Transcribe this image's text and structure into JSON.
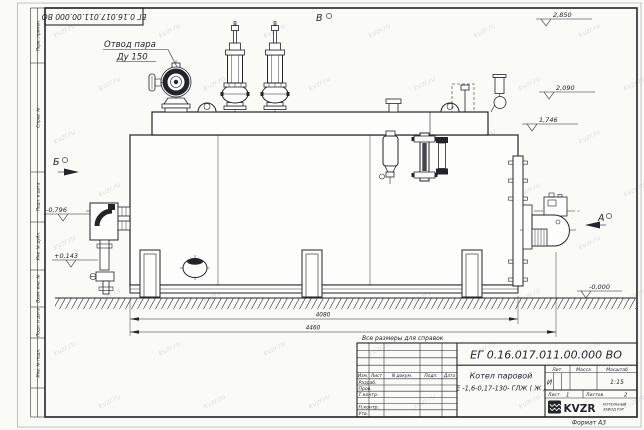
{
  "sheet": {
    "colors": {
      "paper": "#fafaf7",
      "line": "#23242b",
      "watermark": "#c9cdd7"
    },
    "watermark_text": "kvzr.ru",
    "doc_number": "ЕГ 0.16.017.011.00.000  ВО",
    "reference_note": "Все размеры для справок",
    "format_note": "Формат А3"
  },
  "frame_columns": [
    "Перв. примен.",
    "Справ. №",
    "Подп. и дата",
    "Инв. № дубл.",
    "Взам. инв. №",
    "Подп. и дата",
    "Инв. № подл."
  ],
  "drawing": {
    "callout_steam_line1": "Отвод пара",
    "callout_steam_line2": "Ду 150",
    "views": {
      "a": "А",
      "b": "Б",
      "v": "В"
    },
    "elevations": [
      "2,850",
      "2,090",
      "1,746",
      "-0,796",
      "+0,143",
      "-0,000"
    ],
    "dimensions": [
      "4080",
      "4460"
    ]
  },
  "title_block": {
    "header_cols": [
      "Изм.",
      "Лист",
      "N докум.",
      "Подп.",
      "Дата"
    ],
    "sign_rows": [
      "Разраб.",
      "Пров.",
      "Т.контр.",
      "Н.контр.",
      "Утв."
    ],
    "product_name": "Котел паровой",
    "designation": "Е -1,6-0,17-130- ГЛЖ ( Ж )",
    "lit_label": "Лит.",
    "lit_value": "И",
    "mass_label": "Масса",
    "scale_label": "Масштаб",
    "scale_value": "1:15",
    "sheet_label": "Лист",
    "sheet_value": "1",
    "sheets_label": "Листов",
    "sheets_value": "2",
    "brand": "KVZR",
    "brand_line1": "КОТЕЛЬНЫЙ",
    "brand_line2": "ЗАВОД РЭР"
  }
}
